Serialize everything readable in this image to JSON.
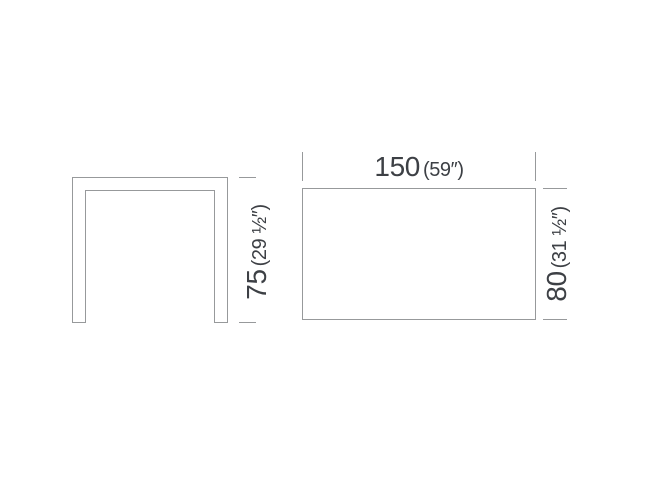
{
  "dimensions": {
    "height": {
      "value": "75",
      "imperial": "(29 ½″)"
    },
    "width": {
      "value": "150",
      "imperial": "(59″)"
    },
    "depth": {
      "value": "80",
      "imperial": "(31 ½″)"
    }
  },
  "colors": {
    "line": "#97999b",
    "text": "#3d4045"
  }
}
